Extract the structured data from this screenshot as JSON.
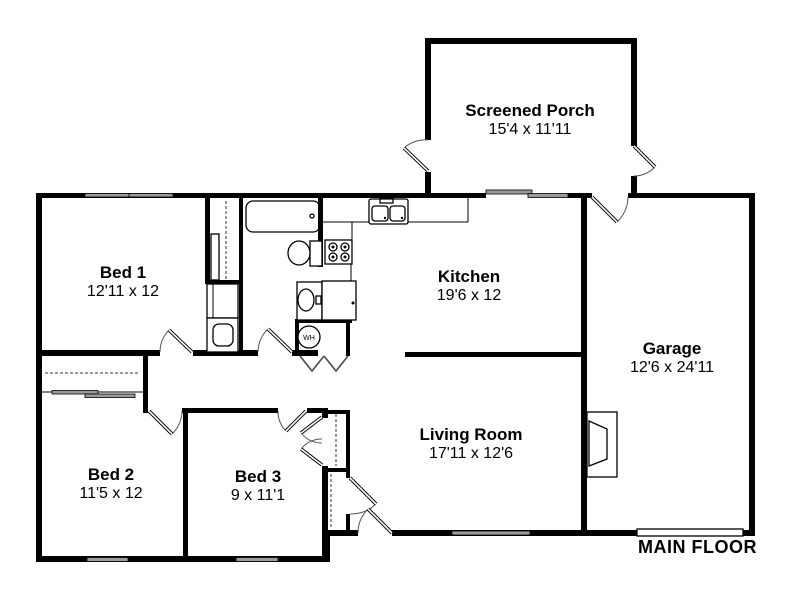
{
  "floor_label": "MAIN FLOOR",
  "rooms": [
    {
      "id": "screened-porch",
      "name": "Screened Porch",
      "dimensions": "15'4 x 11'11"
    },
    {
      "id": "bed-1",
      "name": "Bed 1",
      "dimensions": "12'11 x 12"
    },
    {
      "id": "kitchen",
      "name": "Kitchen",
      "dimensions": "19'6 x 12"
    },
    {
      "id": "garage",
      "name": "Garage",
      "dimensions": "12'6 x 24'11"
    },
    {
      "id": "living-room",
      "name": "Living Room",
      "dimensions": "17'11 x 12'6"
    },
    {
      "id": "bed-2",
      "name": "Bed 2",
      "dimensions": "11'5 x 12"
    },
    {
      "id": "bed-3",
      "name": "Bed 3",
      "dimensions": "9 x 11'1"
    }
  ],
  "fixtures": {
    "water_heater_label": "WH"
  },
  "colors": {
    "background": "#ffffff",
    "wall": "#000000",
    "window": "#9b9b9b",
    "door_panel": "#000000",
    "door_arc": "#555555",
    "text": "#000000"
  }
}
